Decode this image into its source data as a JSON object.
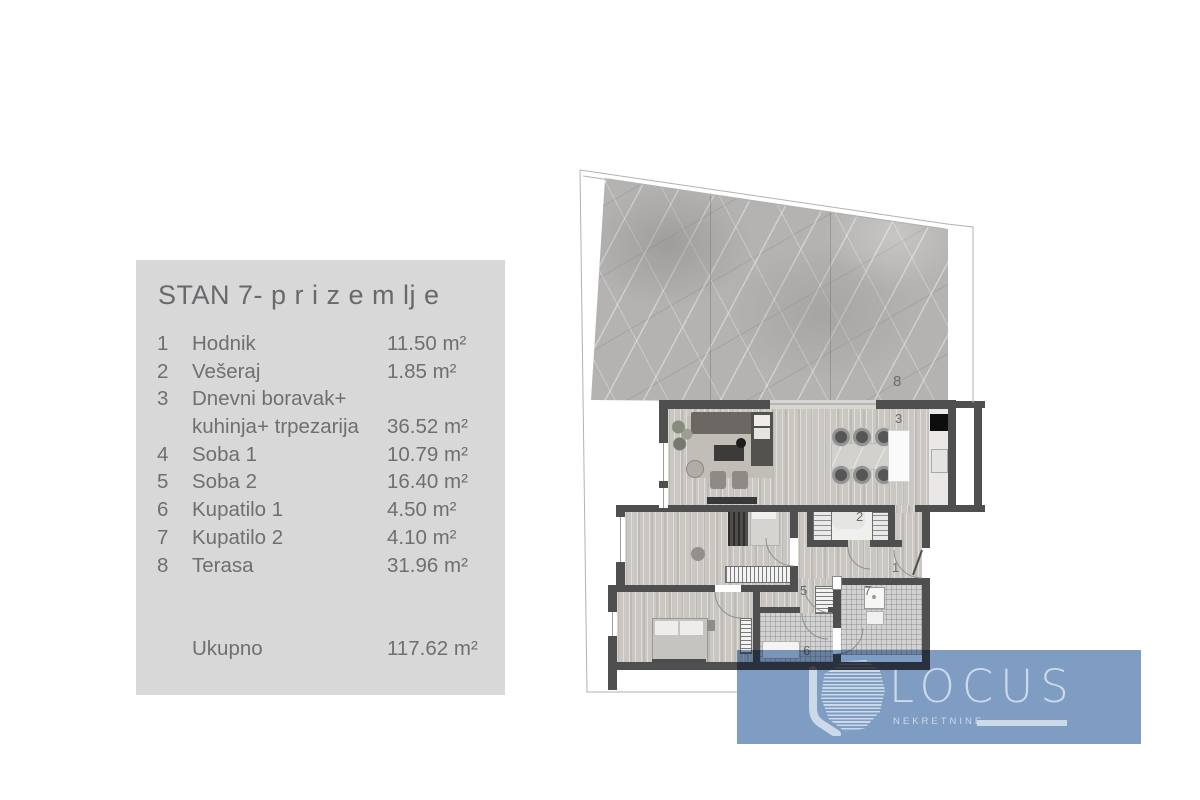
{
  "legend": {
    "title": "STAN 7- p r i z e m lj e",
    "items": [
      {
        "num": "1",
        "name": "Hodnik",
        "area": "11.50 m²"
      },
      {
        "num": "2",
        "name": "Vešeraj",
        "area": "1.85 m²"
      },
      {
        "num": "3",
        "name": "Dnevni boravak+",
        "name2": "kuhinja+ trpezarija",
        "area": "36.52 m²"
      },
      {
        "num": "4",
        "name": "Soba 1",
        "area": "10.79 m²"
      },
      {
        "num": "5",
        "name": "Soba 2",
        "area": "16.40 m²"
      },
      {
        "num": "6",
        "name": "Kupatilo 1",
        "area": "4.50 m²"
      },
      {
        "num": "7",
        "name": "Kupatilo 2",
        "area": "4.10 m²"
      },
      {
        "num": "8",
        "name": "Terasa",
        "area": "31.96 m²"
      }
    ],
    "total_label": "Ukupno",
    "total_area": "117.62 m²"
  },
  "plan": {
    "labels": {
      "hodnik": "1",
      "veseraj": "2",
      "dnevni": "3",
      "soba2": "5",
      "kupatilo1": "6",
      "kupatilo2": "7",
      "terasa": "8"
    }
  },
  "logo": {
    "name": "LOCUS",
    "subtitle": "NEKRETNINE"
  },
  "colors": {
    "panel_gray": "#d8d8d8",
    "text_gray": "#6e6f72",
    "wall_dark": "#4f4f4f",
    "logo_blue": "#7f9cc3"
  }
}
